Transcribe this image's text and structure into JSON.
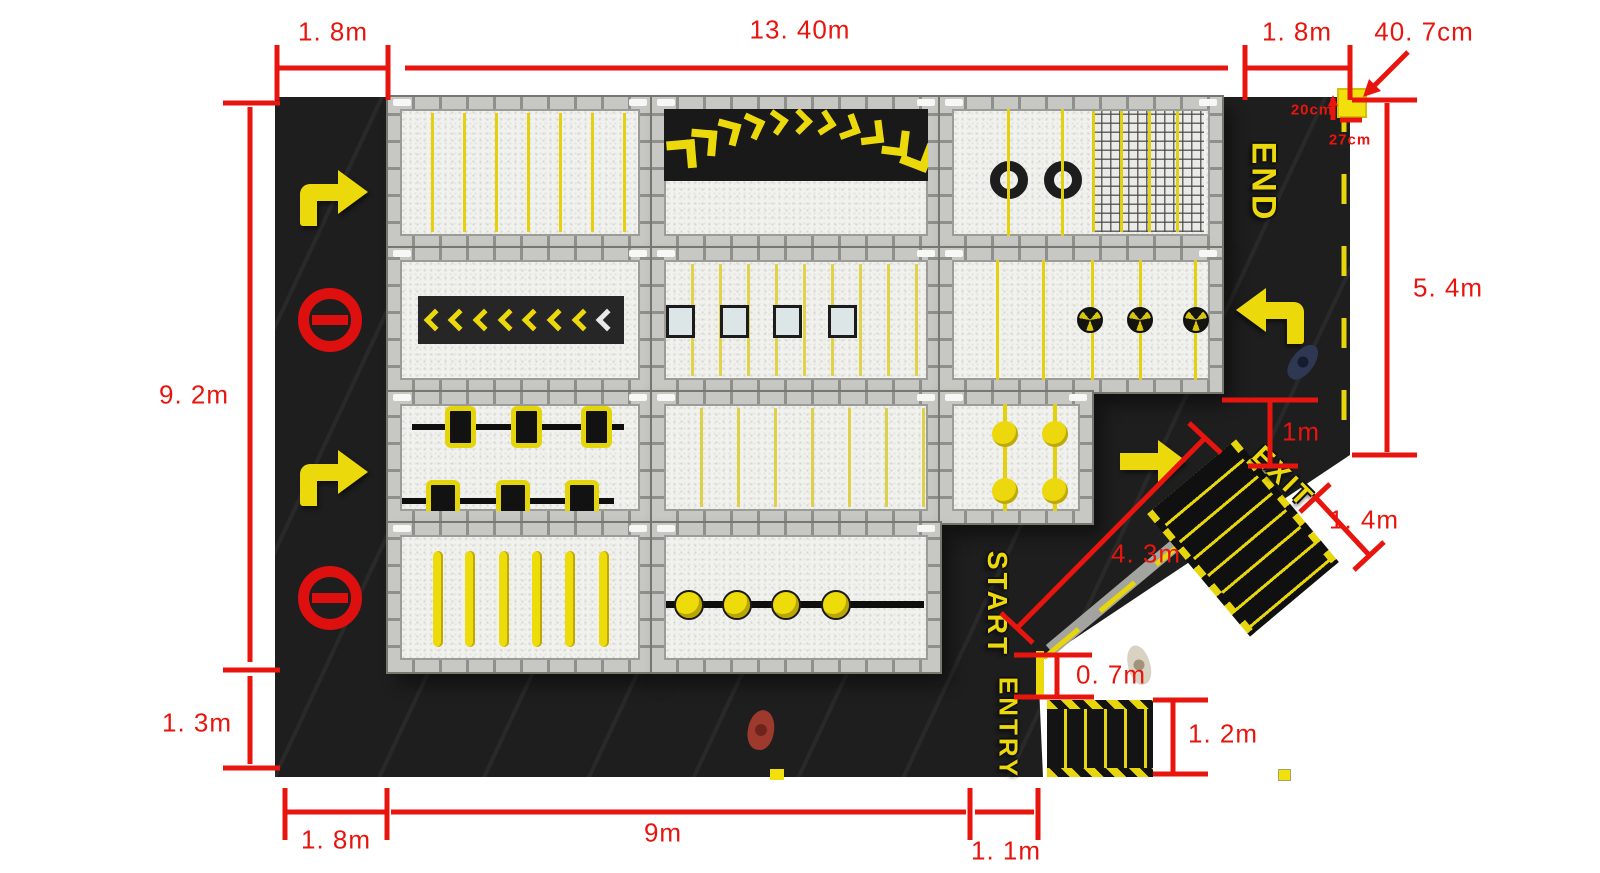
{
  "plan": {
    "waypoints": {
      "end": "END",
      "exit": "EXIT",
      "start": "START",
      "entry": "ENTRY"
    },
    "dimensions": {
      "top_left_width": "1. 8m",
      "top_total_width": "13. 40m",
      "top_right_width": "1. 8m",
      "corner_block": "40. 7cm",
      "block_offset_x": "20cm",
      "block_offset_y": "27cm",
      "right_height": "5. 4m",
      "exit_gap": "1m",
      "exit_stairs_width": "1. 4m",
      "ramp_length": "4. 3m",
      "start_platform_width": "0. 7m",
      "entry_stairs_width": "1. 2m",
      "entry_gap": "1. 1m",
      "bottom_main_width": "9m",
      "bottom_left_width": "1. 8m",
      "left_lower_height": "1. 3m",
      "left_main_height": "9. 2m"
    },
    "colors": {
      "dimension_red": "#e8150f",
      "marking_yellow": "#ecd90b",
      "floor_black": "#1e1e1e",
      "frame_gray": "#b5b5b1",
      "sign_red": "#dd0f0f"
    }
  }
}
